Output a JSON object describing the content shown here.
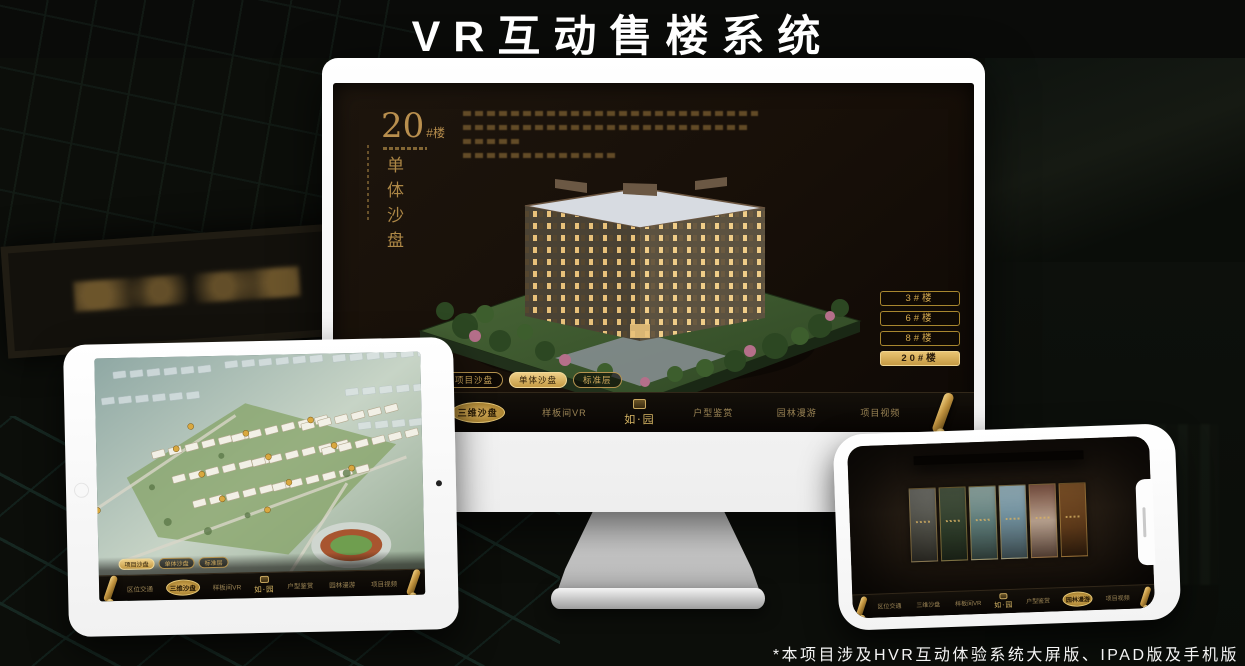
{
  "header": {
    "title": "VR互动售楼系统"
  },
  "footer": {
    "note": "*本项目涉及HVR互动体验系统大屏版、IPAD版及手机版"
  },
  "brand": {
    "logo_text": "如·园",
    "seal_icon": "gold-seal"
  },
  "nav": {
    "items": [
      "区位交通",
      "三维沙盘",
      "样板间VR",
      "户型鉴赏",
      "园林漫游",
      "项目视频"
    ],
    "scroll_icon": "gold-scroll"
  },
  "tabs": {
    "items": [
      "项目沙盘",
      "单体沙盘",
      "标准层"
    ]
  },
  "monitor": {
    "heading_number": "20",
    "heading_suffix": "#楼",
    "heading_sub": "单体沙盘",
    "active_tab": "单体沙盘",
    "active_nav": "三维沙盘",
    "floor_buttons": [
      "3#楼",
      "6#楼",
      "8#楼",
      "20#楼"
    ],
    "active_floor": "20#楼"
  },
  "ipad": {
    "active_tab": "项目沙盘",
    "active_nav": "三维沙盘",
    "content": "项目鸟瞰沙盘"
  },
  "phone": {
    "active_nav": "园林漫游",
    "content": "园林全景场景选择",
    "scene_panel_count": 6
  },
  "colors": {
    "gold": "#c9a050",
    "gold_bright": "#ecd088",
    "screen_bg": "#170f08",
    "nav_bg": "#0b0805",
    "device_white": "#f7f7f7",
    "title_text": "#ffffff"
  }
}
